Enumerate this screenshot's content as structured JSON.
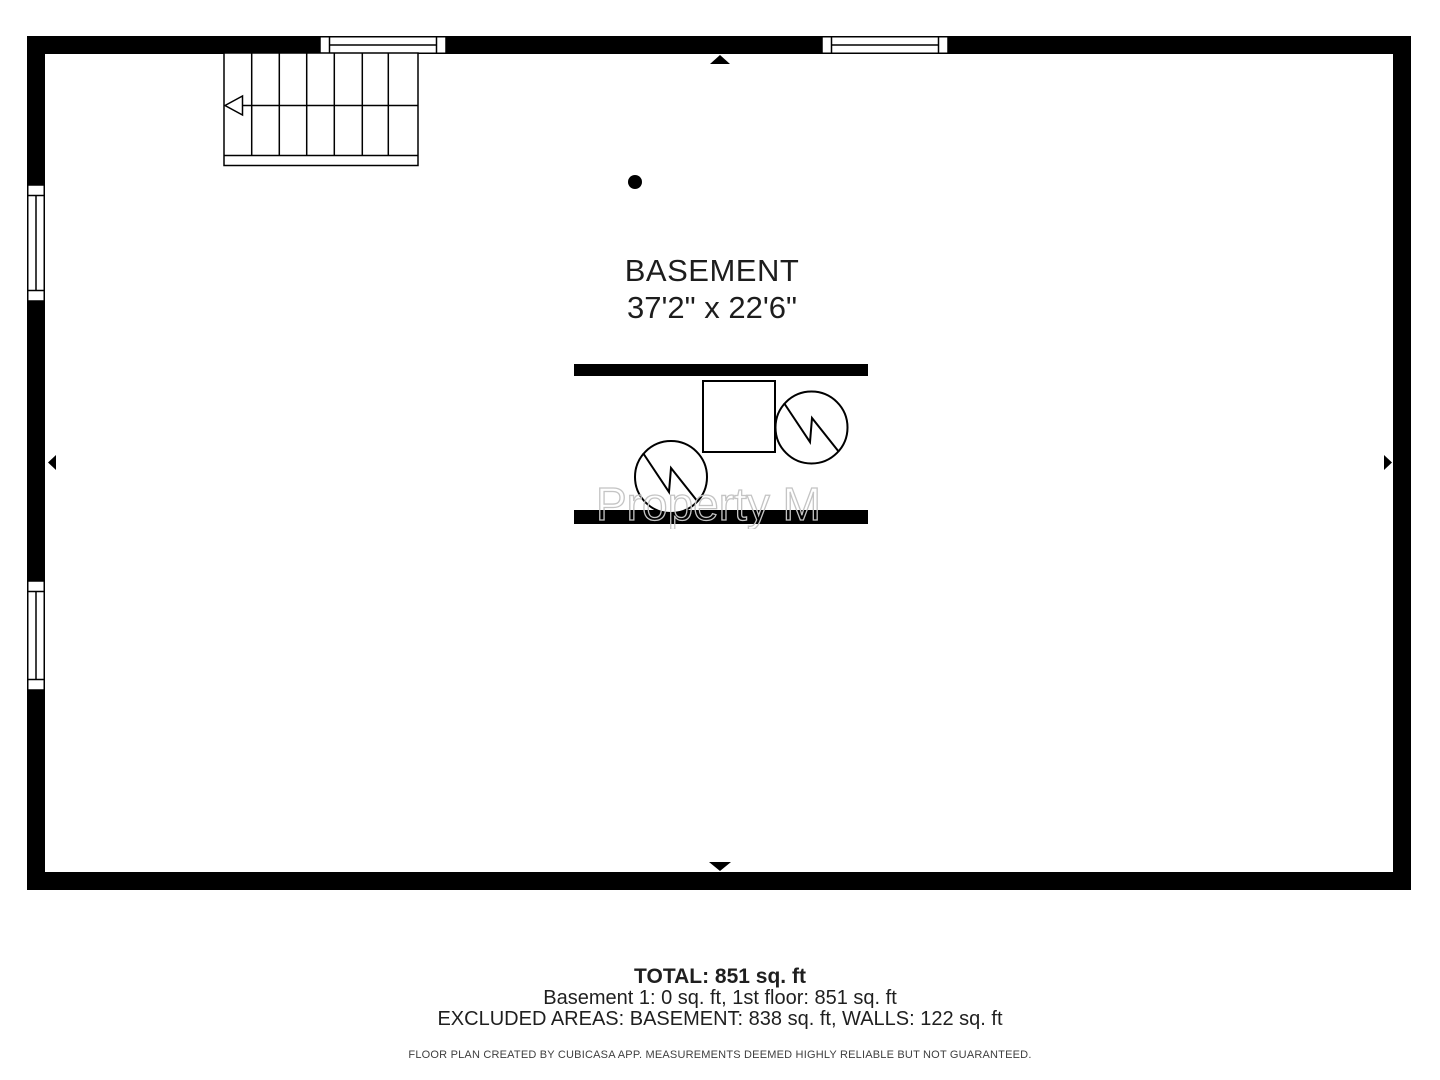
{
  "room": {
    "label": "BASEMENT",
    "dimensions": "37'2\" x 22'6\""
  },
  "watermark": {
    "text": "Property M"
  },
  "footer": {
    "total": "TOTAL: 851 sq. ft",
    "breakdown": "Basement 1: 0 sq. ft, 1st floor: 851 sq. ft",
    "excluded": "EXCLUDED AREAS: BASEMENT: 838 sq. ft, WALLS: 122 sq. ft",
    "disclaimer": "FLOOR PLAN CREATED BY CUBICASA APP. MEASUREMENTS DEEMED HIGHLY RELIABLE BUT NOT GUARANTEED."
  },
  "colors": {
    "wall": "#000000",
    "background": "#ffffff",
    "text": "#1d1d1d",
    "disclaimer_text": "#3e3e3e",
    "watermark_stroke": "#c4c4c4"
  },
  "icons": {
    "stairs": "stairs-symbol",
    "stair_arrow": "stair-direction-arrow",
    "windows": [
      "window-top-left",
      "window-top-right",
      "window-left-upper",
      "window-left-lower"
    ],
    "wall_markers": [
      "wall-marker-top",
      "wall-marker-bottom",
      "wall-marker-left",
      "wall-marker-right"
    ],
    "fixtures": [
      "ceiling-fixture-dot",
      "furnace-unit",
      "water-heater-left",
      "water-heater-right"
    ]
  }
}
